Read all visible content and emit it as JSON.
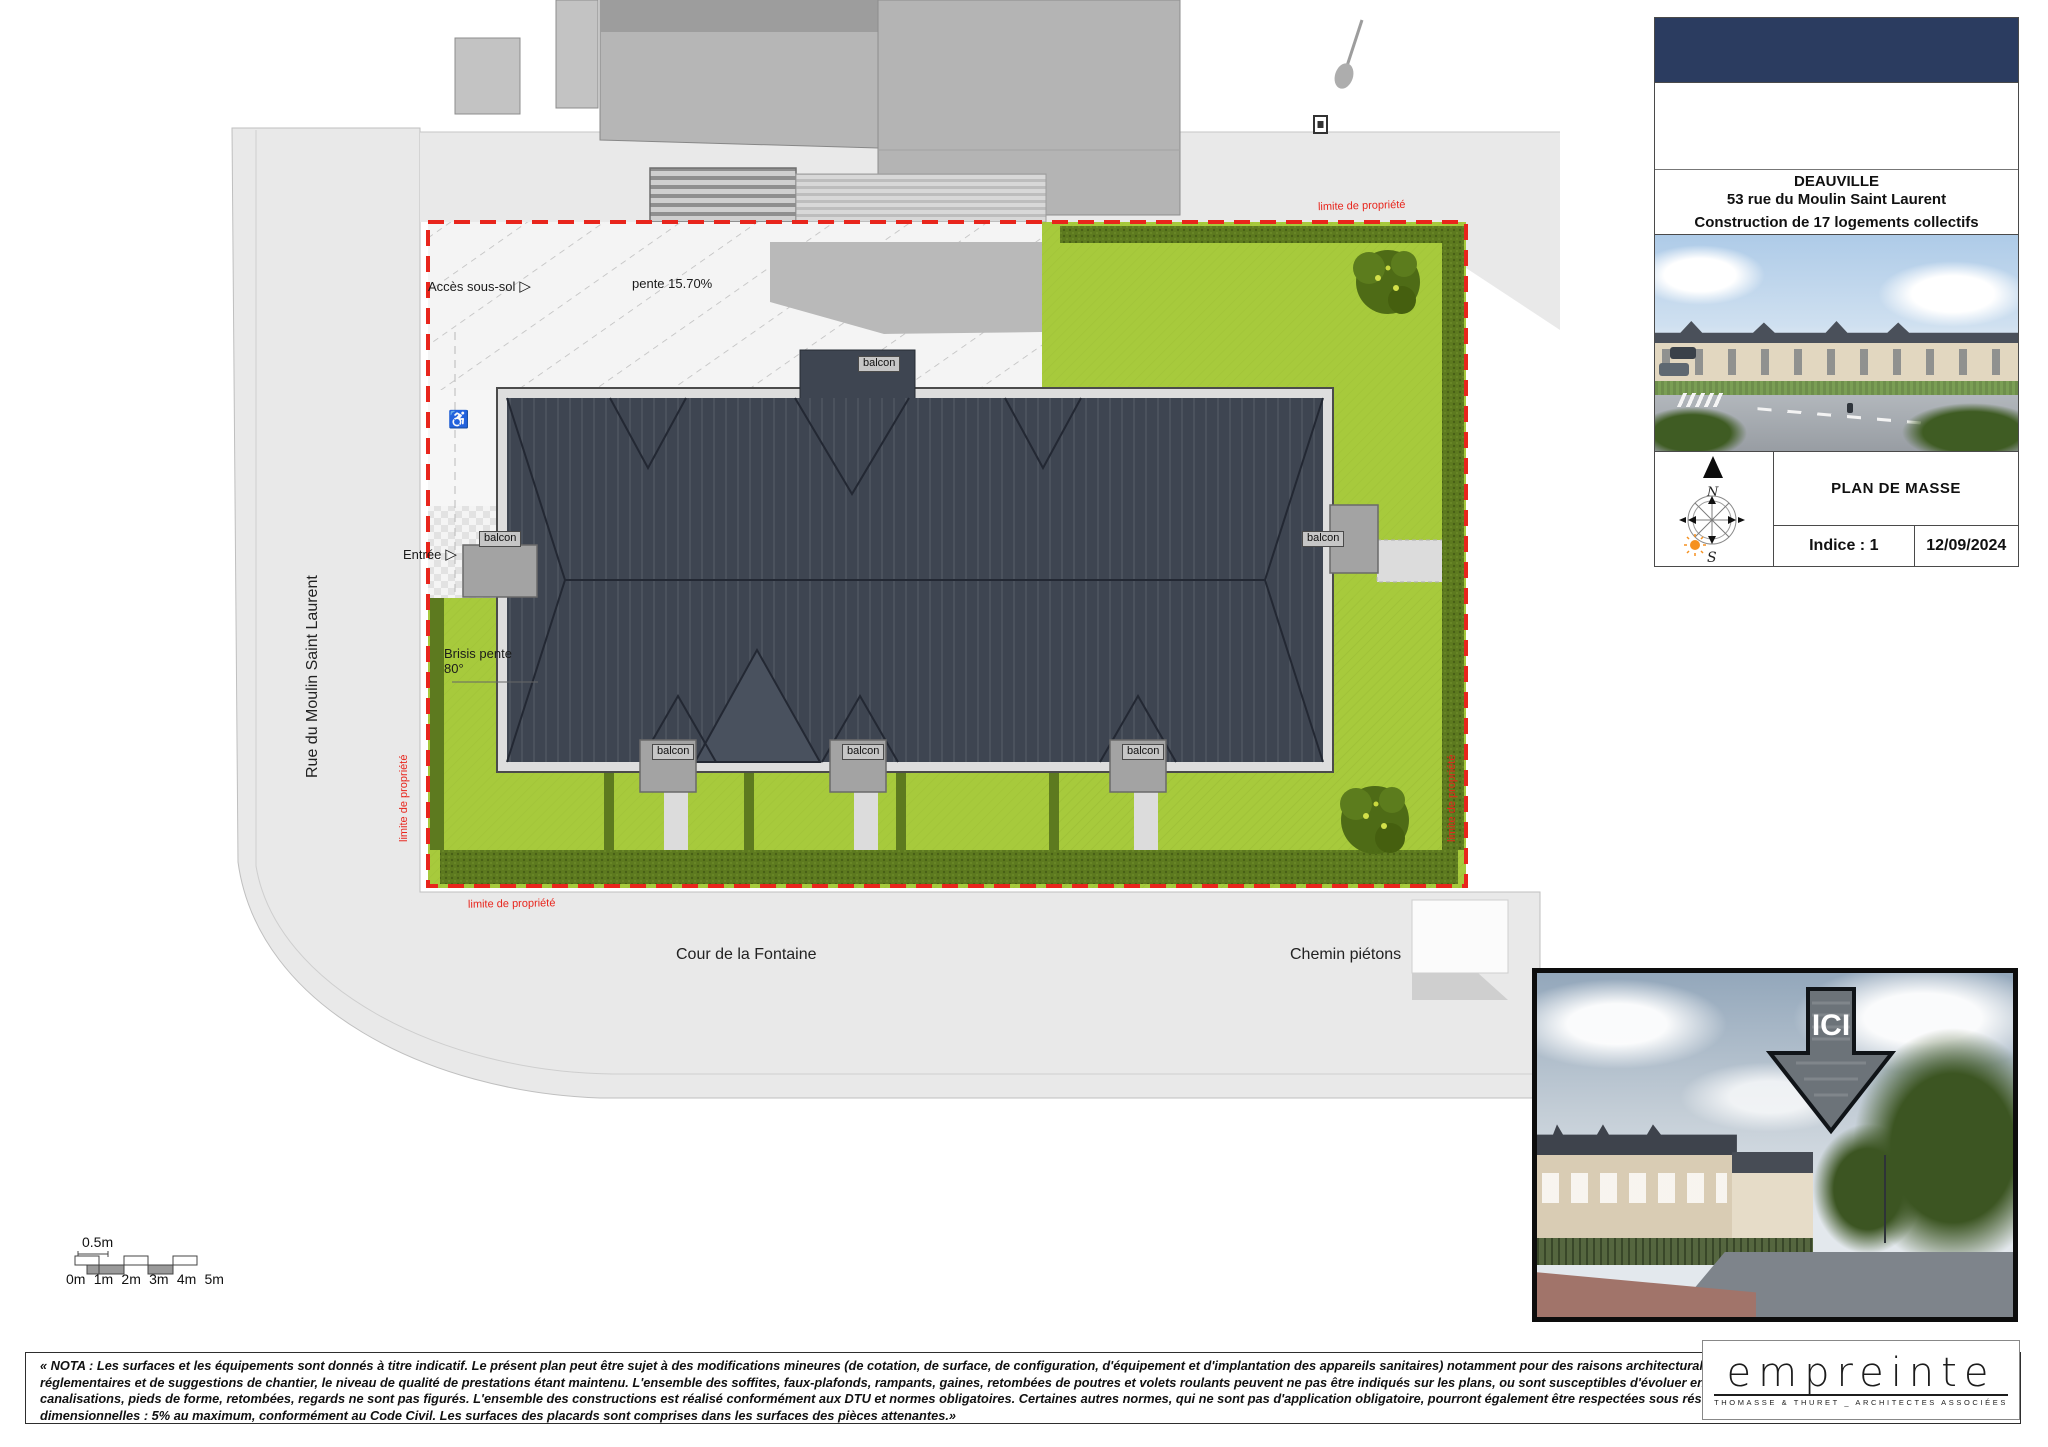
{
  "title_block": {
    "city": "DEAUVILLE",
    "address_line": "53 rue du Moulin Saint Laurent",
    "project_line": "Construction de 17 logements collectifs",
    "drawing_name": "PLAN DE MASSE",
    "revision": "Indice : 1",
    "date": "12/09/2024",
    "compass_north": "N",
    "compass_south": "S"
  },
  "plan": {
    "street_left": "Rue du Moulin Saint Laurent",
    "street_bottom": "Cour de la Fontaine",
    "pedestrian_path": "Chemin piétons",
    "basement_access": "Accès sous-sol",
    "ramp_slope": "pente 15.70%",
    "entrance": "Entrée",
    "balcony": "balcon",
    "roof_slope_line1": "Brisis pente",
    "roof_slope_line2": "80°",
    "property_limit": "limite de propriété"
  },
  "icons": {
    "wheelchair": "♿",
    "arrow_right": "▷"
  },
  "scale_bar": {
    "half_meter": "0.5m",
    "ticks": [
      "0m",
      "1m",
      "2m",
      "3m",
      "4m",
      "5m"
    ]
  },
  "inset_photo": {
    "marker_label": "ICI"
  },
  "legal_note": "« NOTA : Les surfaces et les équipements sont donnés à titre indicatif. Le présent plan peut être sujet à des modifications mineures (de cotation, de surface, de configuration, d'équipement et d'implantation des appareils sanitaires) notamment pour des raisons architecturales, de détails d'exécution, de techniques réglementaires et de suggestions de chantier, le niveau de qualité de prestations étant maintenu. L'ensemble des soffites, faux-plafonds, rampants, gaines, retombées de poutres et volets roulants peuvent ne pas être indiqués sur les plans, ou sont susceptibles d'évoluer en situation, en nombre et en dimension. Les canalisations, pieds de forme, retombées, regards ne sont pas figurés. L'ensemble des constructions est réalisé conformément aux DTU et normes obligatoires. Certaines autres normes, qui ne sont pas d'application obligatoire, pourront également être respectées sous réserve d'adaptations mineures. Tolérances dimensionnelles : 5% au maximum, conformément au Code Civil. Les surfaces des placards sont comprises dans les surfaces des pièces attenantes.»",
  "logo": {
    "wordmark": "empreinte",
    "tagline": "THOMASSE & THURET _ ARCHITECTES ASSOCIÉES"
  },
  "colors": {
    "lawn": "#a7ca3c",
    "hedge": "#5d7a1f",
    "roof": "#3e4551",
    "property_line": "#e8251c",
    "road": "#e9e9e9",
    "existing_building": "#b5b5b5",
    "header_navy": "#2b3c60"
  }
}
